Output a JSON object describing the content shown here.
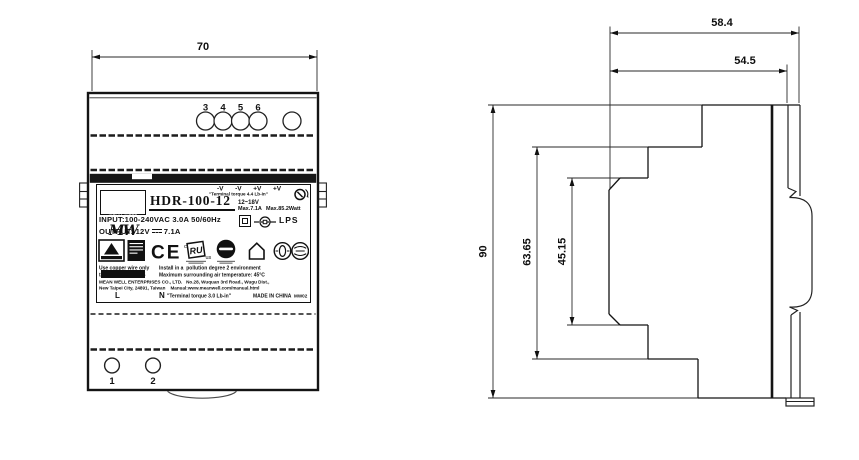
{
  "drawing": {
    "front_view": {
      "width_dim": "70",
      "top_terminals": [
        "3",
        "4",
        "5",
        "6"
      ],
      "bottom_terminals": [
        "1",
        "2"
      ]
    },
    "label": {
      "brand_logo": "MW",
      "brand_name": "MEAN WELL",
      "model": "HDR-100-12",
      "polarity": "-V  -V  +V  +V",
      "torque_top": "\"Terminal torque 4.4 Lb-in\"",
      "vadj_range": "12~18V",
      "max_current": "Max.7.1A",
      "max_power": "Max.85.2Watt",
      "input_spec": "INPUT:100-240VAC 3.0A 50/60Hz",
      "output_label": "OUTPUT: 12V",
      "output_current": "7.1A",
      "lps": "LPS",
      "ce": "CE",
      "ul_c": "c",
      "ul_core": "RU",
      "ul_us": "us",
      "note_wire": "Use copper wire only",
      "note_tc": "ta:45°C   cos φ:0.45",
      "note_pollution": "Install in a  pollution degree 2 environment",
      "note_temp": "Maximum surrounding air temperature: 45°C",
      "company_line": "MEAN WELL ENTERPRISES CO., LTD.   No.28, Wuquan 3rd Road., Wugu Dist.,",
      "address_line": "New Taipei City, 24891, Taiwan    Manual:www.meanwell.com/manual.html",
      "line_l": "L",
      "line_n": "N",
      "torque_bottom": "\"Terminal torque 3.0 Lb-in\"",
      "made_in": "MADE IN CHINA",
      "code": "MW02"
    },
    "side_view": {
      "depth_overall": "58.4",
      "depth_case": "54.5",
      "height_overall": "90",
      "height_mid": "63.65",
      "height_front": "45.15"
    }
  }
}
